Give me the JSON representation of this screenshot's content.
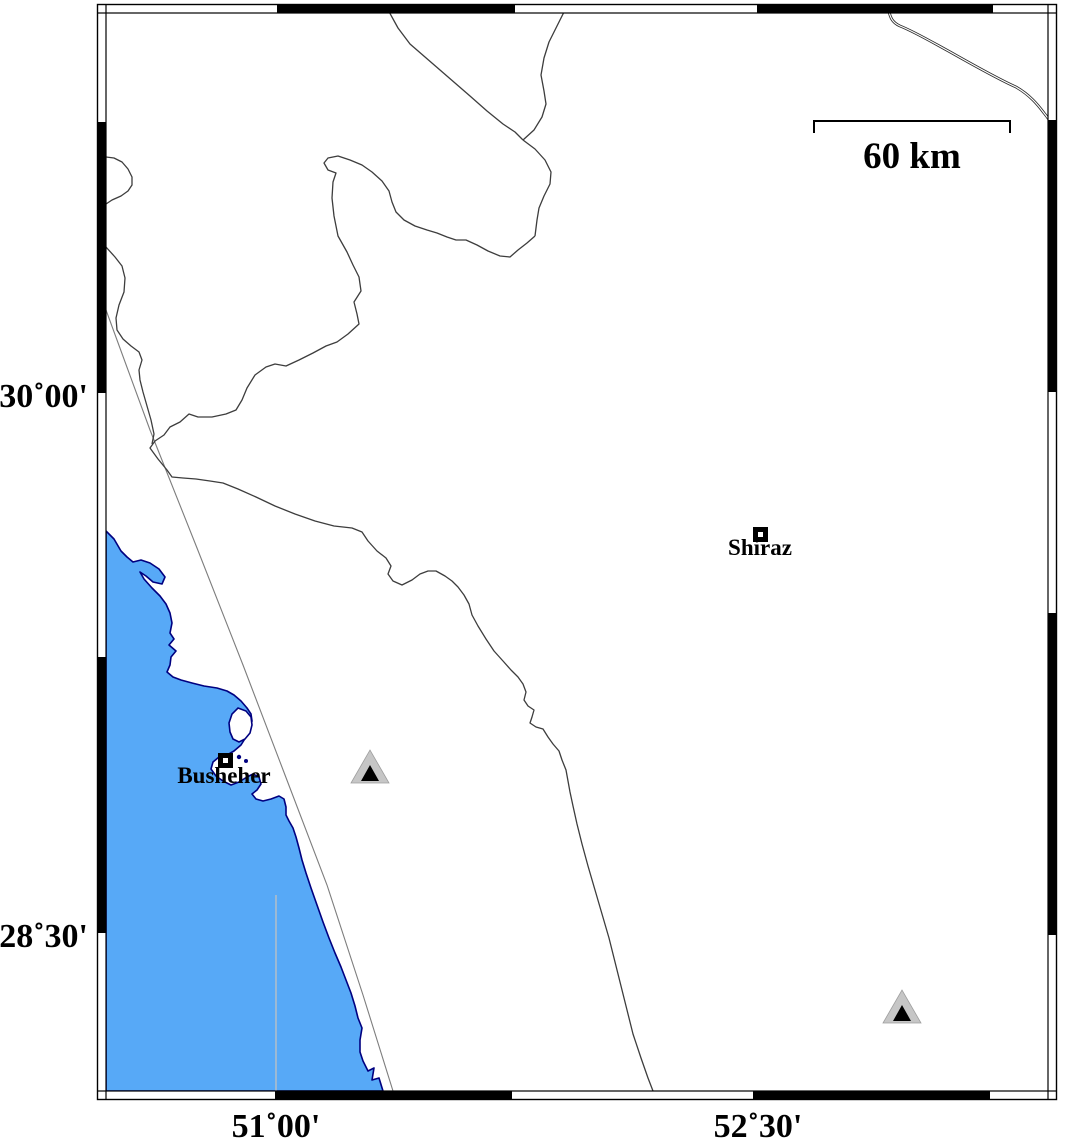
{
  "map": {
    "width": 1066,
    "height": 1141,
    "colors": {
      "sea": "#57a9f7",
      "coast": "#000080",
      "land": "#ffffff",
      "boundary": "#3d3d3d",
      "fault": "#7d7d7d",
      "faint_line": "#c2c2c2",
      "river_casing": "#2b2b2b",
      "river_core": "#ffffff",
      "frame": "#000000",
      "station_fill": "#c6c6c6",
      "station_edge": "#9e9e9e",
      "station_inner": "#000000"
    },
    "frame": {
      "outer": {
        "x": 97.5,
        "y": 4.5,
        "w": 959,
        "h": 1095
      },
      "inner": {
        "x": 106,
        "y": 13,
        "w": 942,
        "h": 1078
      },
      "top_black": [
        [
          277,
          515
        ],
        [
          757,
          993
        ]
      ],
      "bottom_black": [
        [
          275,
          512
        ],
        [
          753,
          990
        ]
      ],
      "left_black": [
        [
          122,
          393
        ],
        [
          657,
          933
        ]
      ],
      "right_black": [
        [
          120,
          392
        ],
        [
          613,
          935
        ]
      ]
    },
    "axis_labels": [
      {
        "id": "axis-label-30-00",
        "text": "30˚00'",
        "x": 88,
        "y": 407,
        "size": 34,
        "anchor": "end"
      },
      {
        "id": "axis-label-28-30",
        "text": "28˚30'",
        "x": 88,
        "y": 947,
        "size": 34,
        "anchor": "end"
      },
      {
        "id": "axis-label-51-00",
        "text": "51˚00'",
        "x": 276,
        "y": 1137,
        "size": 34,
        "anchor": "middle"
      },
      {
        "id": "axis-label-52-30",
        "text": "52˚30'",
        "x": 758,
        "y": 1137,
        "size": 34,
        "anchor": "middle"
      }
    ],
    "scale_bar": {
      "label": "60 km",
      "x1": 814,
      "x2": 1010,
      "y_top": 121,
      "y_bottom": 133,
      "label_x": 912,
      "label_y": 168,
      "size": 37
    },
    "cities": [
      {
        "id": "shiraz",
        "name": "Shiraz",
        "marker": {
          "x": 755.5,
          "y": 529.5,
          "w": 10,
          "h": 10,
          "stroke": 5
        },
        "label": {
          "text": "Shiraz",
          "x": 760,
          "y": 555,
          "size": 23,
          "anchor": "middle"
        }
      },
      {
        "id": "busheher",
        "name": "Busheher",
        "marker": {
          "x": 220.5,
          "y": 755.5,
          "w": 10,
          "h": 10,
          "stroke": 5
        },
        "label": {
          "text": "Busheher",
          "x": 224,
          "y": 783,
          "size": 23,
          "anchor": "middle"
        }
      }
    ],
    "stations": [
      {
        "id": "station-1",
        "outer": "351,783 389,783 370,750",
        "inner": "361,781 379,781 370,765"
      },
      {
        "id": "station-2",
        "outer": "883,1023 921,1023 902,990",
        "inner": "893,1021 911,1021 902,1005"
      }
    ],
    "features": {
      "sea": {
        "d": "M106,531 L114,539 L121,551 L127,557 L133,562 L141,560 L150,563 L159,569 L165,577 L162,584 L153,582 L146,576 L140,572 L144,579 L152,588 L160,596 L166,604 L170,613 L172,623 L170,633 L174,639 L169,645 L176,651 L171,657 L170,665 L167,672 L173,677 L181,680 L192,683 L204,686 L217,688 L227,691 L234,695 L241,701 L247,708 L251,714 L252,721 L250,729 L246,737 L241,745 L234,751 L227,755 L219,757 L213,762 L211,769 L216,776 L223,781 L231,785 L239,782 L247,777 L253,774 L259,777 L261,784 L257,790 L252,794 L256,799 L263,801 L271,799 L279,796 L284,799 L286,807 L286,815 L289,821 L293,828 L296,837 L299,848 L302,860 L306,873 L311,888 L317,905 L323,922 L329,938 L335,953 L341,967 L346,980 L351,993 L355,1006 L358,1018 L362,1028 L360,1040 L360,1052 L363,1061 L368,1071 L374,1068 L372,1080 L379,1078 L383,1091 L106,1091 Z"
      },
      "island": {
        "d": "M238,708 L246,711 L251,717 L252,725 L250,733 L245,739 L239,742 L233,739 L230,732 L229,723 L232,714 Z"
      },
      "islets": [
        {
          "cx": 239,
          "cy": 757,
          "r": 2.2
        },
        {
          "cx": 246,
          "cy": 761,
          "r": 2.0
        }
      ],
      "boundaries": [
        {
          "id": "boundary-north-a",
          "d": "M387,8 L398,28 L410,44 L425,57 L440,70 L455,83 L470,96 L487,111 L503,124 L515,132 L523,140"
        },
        {
          "id": "boundary-north-b",
          "d": "M565,10 L557,26 L549,42 L544,58 L541,75 L544,91 L546,104 L542,117 L534,130 L523,140"
        },
        {
          "id": "boundary-junction",
          "d": "M523,140 L535,149 L545,160 L551,172 L550,184 L544,196 L539,208 L537,220 L535,236"
        },
        {
          "id": "boundary-frame-bump",
          "d": "M106,157 L114,158 L122,162 L128,169 L132,177 L132,185 L128,191 L121,196 L112,200 L106,204"
        },
        {
          "id": "boundary-frame-west",
          "d": "M106,247 L115,257 L122,266 L125,278 L124,292 L119,305 L116,318 L117,330 L123,339 L131,346 L139,352 L142,360 L139,370 L140,380 L143,392 L147,406 L151,420 L154,434 L152,444"
        },
        {
          "id": "boundary-main",
          "d": "M535,236 L527,243 L518,250 L510,257 L500,256 L488,251 L477,245 L466,240 L456,240 L447,237 L437,233 L427,230 L415,226 L404,220 L396,212 L392,202 L389,191 L382,181 L372,172 L362,165 L350,160 L338,156 L328,158 L324,163 L328,170 L336,173 L333,182 L332,198 L334,216 L338,236 L347,252 L353,265 L359,277 L361,291 L354,302 L357,314 L359,324 L348,334 L337,342 L326,346 L313,353 L299,360 L286,366 L275,364 L266,367 L255,375 L247,388 L242,400 L236,410 L226,414 L212,417 L198,417 L189,414 L180,422 L170,427 L164,435 L155,441 L150,448 L158,459 L167,470 L172,477 L183,478 L196,479 L210,481 L223,483 L238,489 L256,497 L275,506 L295,514 L315,521 L334,526 L352,528 L362,532 L368,541 L377,551 L386,558 L391,566 L388,574 L393,581 L402,585 L412,580 L420,574 L428,571 L436,571 L445,576 L452,581 L458,587 L464,595 L469,604 L472,615 L478,626 L486,639 L494,651 L503,661 L511,670 L518,677 L523,684 L526,692 L524,700 L528,706 L534,710 L532,717 L530,723 L536,727 L543,729 L548,737 L553,744 L559,751 L562,760 L566,770 L568,781 L570,792 L573,806 L577,824 L582,844 L588,866 L595,890 L602,914 L609,938 L615,962 L621,986 L627,1010 L633,1034 L641,1058 L648,1078 L653,1091"
        }
      ],
      "fault_line": {
        "d": "M106,310 L150,430 L197,548 L243,665 L285,775 L327,885 L363,995 L393,1091"
      },
      "faint_line": {
        "d": "M276,895 L276,1091"
      },
      "river": {
        "d": "M888,8 C890,16 891,22 900,26 C915,32 930,41 952,53 C975,66 998,79 1016,87 C1030,95 1038,105 1044,113 C1049,119 1052,124 1055,129"
      }
    }
  }
}
